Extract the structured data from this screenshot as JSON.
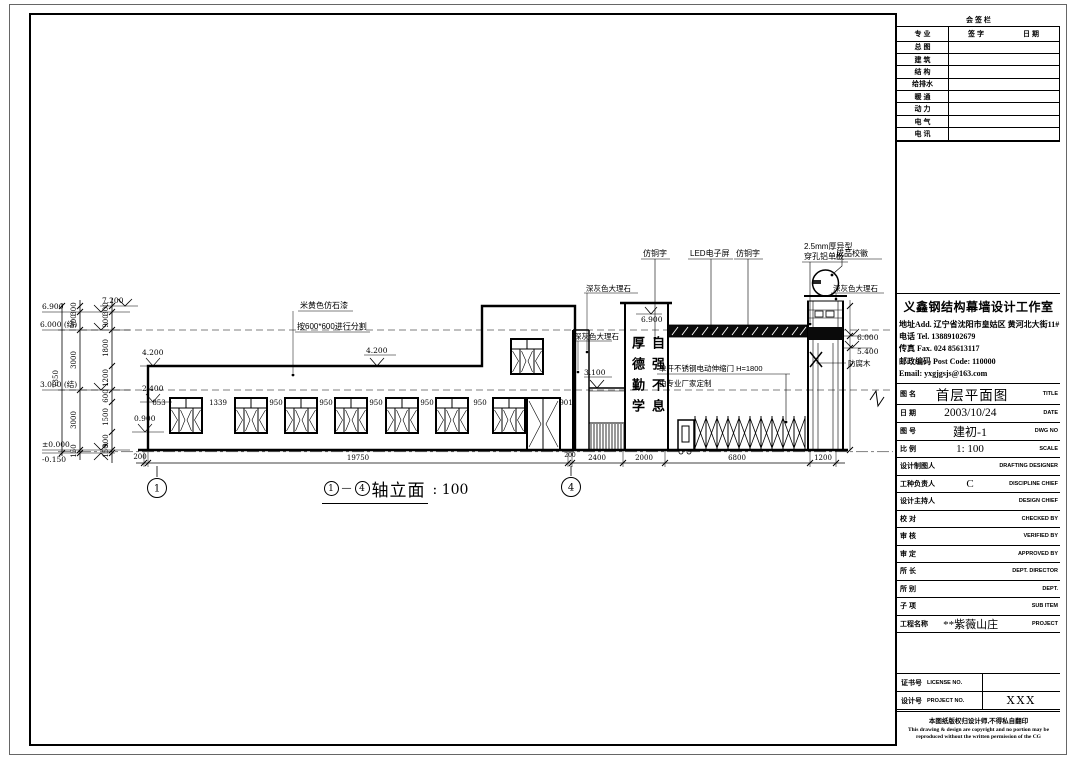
{
  "sign_table": {
    "title": "会 签 栏",
    "col_headers": [
      "专 业",
      "签 字",
      "日 期"
    ],
    "rows": [
      "总 图",
      "建 筑",
      "结 构",
      "给排水",
      "暖 通",
      "动 力",
      "电 气",
      "电 讯"
    ]
  },
  "company": {
    "name": "义鑫钢结构幕墙设计工作室",
    "address": "地址Add. 辽宁省沈阳市皇姑区 黄河北大街11#",
    "tel": "电话 Tel.  13889102679",
    "fax": "传真 Fax. 024 85613117",
    "post": "邮政编码 Post Code: 110000",
    "email": "Email: yxgjgsjs@163.com"
  },
  "info_rows": [
    {
      "label": "图 名",
      "value": "首层平面图",
      "en": "TITLE"
    },
    {
      "label": "日 期",
      "value": "2003/10/24",
      "en": "DATE"
    },
    {
      "label": "图 号",
      "value": "建初-1",
      "en": "DWG NO"
    },
    {
      "label": "比 例",
      "value": "1: 100",
      "en": "SCALE"
    },
    {
      "label": "设计制图人",
      "value": "",
      "en": "DRAFTING DESIGNER"
    },
    {
      "label": "工种负责人",
      "value": "C",
      "en": "DISCIPLINE CHIEF"
    },
    {
      "label": "设计主持人",
      "value": "",
      "en": "DESIGN CHIEF"
    },
    {
      "label": "校 对",
      "value": "",
      "en": "CHECKED BY"
    },
    {
      "label": "审 核",
      "value": "",
      "en": "VERIFIED BY"
    },
    {
      "label": "审 定",
      "value": "",
      "en": "APPROVED BY"
    },
    {
      "label": "所 长",
      "value": "",
      "en": "DEPT. DIRECTOR"
    },
    {
      "label": "所 别",
      "value": "",
      "en": "DEPT."
    },
    {
      "label": "子 项",
      "value": "",
      "en": "SUB ITEM"
    },
    {
      "label": "工程名称",
      "value": "**紫薇山庄",
      "en": "PROJECT"
    }
  ],
  "license": {
    "label": "证书号",
    "en": "LICENSE NO.",
    "value": ""
  },
  "project_no": {
    "label": "设计号",
    "en": "PROJECT NO.",
    "value": "XXX"
  },
  "copyright": {
    "cn": "本图纸版权归设计师,不得私自翻印",
    "en": "This drawing & design are copyright and no portion may be reproduced without the written permission of the CG"
  },
  "caption": {
    "axis_start": "1",
    "separator": "—",
    "axis_end": "4",
    "name": "轴立面",
    "scale": ": 100"
  },
  "axis_bubbles": {
    "left": "1",
    "right": "4"
  },
  "annotations": {
    "copper1": "仿铜字",
    "led": "LED电子屏",
    "copper2": "仿铜字",
    "alu1": "2.5mm厚异型",
    "alu2": "穿孔铝单板",
    "badge": "成品校徽",
    "marble_top": "深灰色大理石",
    "marble_left": "深灰色大理石",
    "marble_right": "深灰色大理石",
    "paint1": "米黄色仿石漆",
    "paint2": "按600*600进行分割",
    "gate1": "单开不锈钢电动伸缩门 H=1800",
    "gate2": "由专业厂家定制",
    "wood": "防腐木",
    "motto_left": "厚德勤学",
    "motto_right": "自强不息"
  },
  "elevations_left": [
    "6.900",
    "6.000 (结)",
    "3.000 (结)",
    "±0.000",
    "-0.150"
  ],
  "elevations_mid": [
    "7.200",
    "4.200",
    "2.400",
    "0.900"
  ],
  "elevations_drawing": {
    "roof": "4.200",
    "lintel": "3.100",
    "tower": "6.900",
    "pillar_top": "6.000",
    "pillar_mid": "5.400"
  },
  "dims": {
    "chain_outer_total": "7350",
    "chain_outer": [
      "300",
      "900",
      "3000",
      "3000",
      "150"
    ],
    "chain_inner": [
      "300",
      "900",
      "1800",
      "1200",
      "600",
      "1500",
      "900",
      "150"
    ],
    "bottom": [
      "200",
      "19750",
      "200",
      "2400",
      "2000",
      "6800",
      "1200"
    ],
    "windows": [
      "853",
      "1339",
      "950",
      "950",
      "950",
      "950",
      "950",
      "901"
    ]
  }
}
